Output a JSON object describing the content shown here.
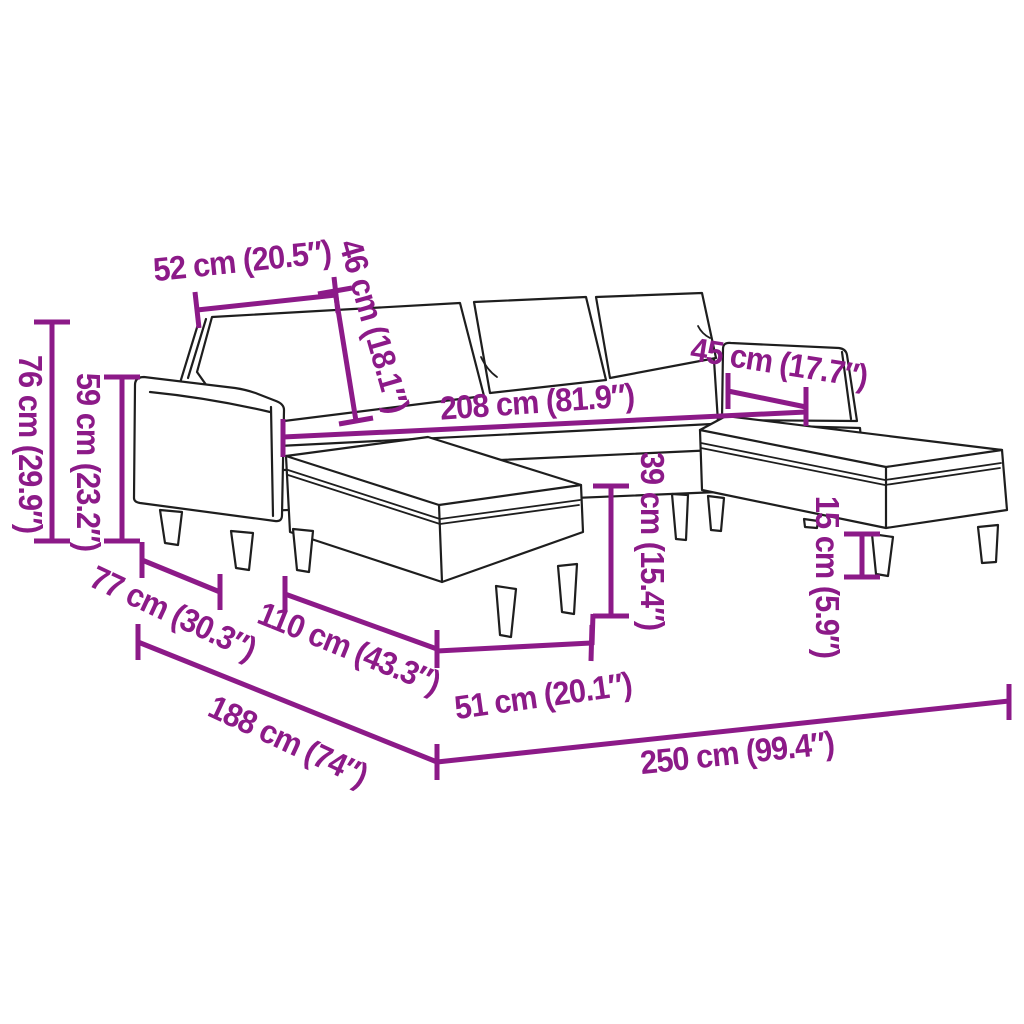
{
  "diagram": {
    "subject": "u-shaped-sofa-with-two-footstools-line-drawing",
    "background_color": "#FFFFFF",
    "outline_color": "#1E1E1E",
    "accent_color": "#8C1A88",
    "measurements": [
      {
        "name": "cushion-width",
        "label": "52 cm (20.5″)"
      },
      {
        "name": "backrest-height",
        "label": "46 cm (18.1″)"
      },
      {
        "name": "total-height",
        "label": "76 cm (29.9″)"
      },
      {
        "name": "armrest-height",
        "label": "59 cm (23.2″)"
      },
      {
        "name": "inner-width",
        "label": "208 cm (81.9″)"
      },
      {
        "name": "chaise-width",
        "label": "45 cm (17.7″)"
      },
      {
        "name": "seat-height",
        "label": "39 cm (15.4″)"
      },
      {
        "name": "leg-height",
        "label": "15 cm (5.9″)"
      },
      {
        "name": "seat-depth",
        "label": "77 cm (30.3″)"
      },
      {
        "name": "footstool-length",
        "label": "110 cm (43.3″)"
      },
      {
        "name": "footstool-width",
        "label": "51 cm (20.1″)"
      },
      {
        "name": "total-depth",
        "label": "188 cm (74″)"
      },
      {
        "name": "total-width",
        "label": "250 cm (99.4″)"
      }
    ]
  }
}
